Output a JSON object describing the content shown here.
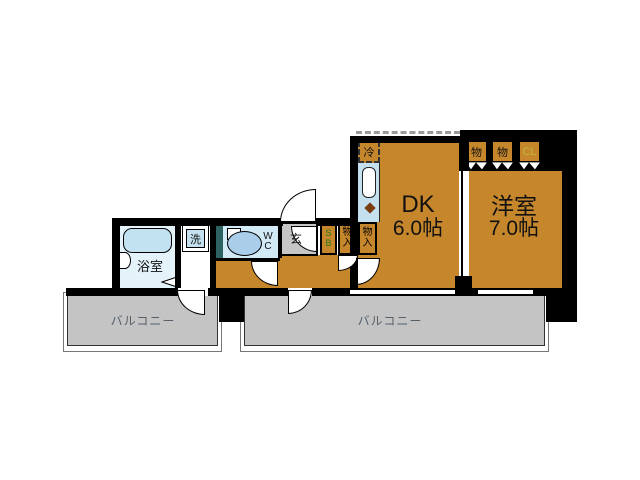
{
  "rooms": {
    "bath": {
      "label": "浴室"
    },
    "washer": {
      "label": "洗"
    },
    "wc": {
      "line1": "W",
      "line2": "C"
    },
    "entrance": {
      "label": "玄"
    },
    "shoebox": {
      "line1": "S",
      "line2": "B"
    },
    "storage1": {
      "line1": "物",
      "line2": "入"
    },
    "storage2": {
      "line1": "物",
      "line2": "入"
    },
    "fridge": {
      "label": "冷"
    },
    "dk": {
      "name": "DK",
      "size": "6.0帖"
    },
    "western": {
      "name": "洋室",
      "size": "7.0帖"
    },
    "closet1": {
      "label": "物"
    },
    "closet2": {
      "label": "物"
    },
    "closet3": {
      "label": "CL"
    },
    "balcony_left": {
      "label": "バルコニー"
    },
    "balcony_right": {
      "label": "バルコニー"
    }
  },
  "colors": {
    "floor_wood": "#C6862B",
    "balcony_gray": "#C4C4C4",
    "bath_blue": "#E4F2FA",
    "tub_blue": "#C2E2F2",
    "wc_blue": "#D2E9F6",
    "kitchen_blue": "#C4E0EF",
    "duct_teal": "#2E6363",
    "wall_black": "#000000",
    "cl_text": "#C2B83A",
    "sb_text": "#1F7A1F",
    "balcony_text": "#55606A"
  }
}
